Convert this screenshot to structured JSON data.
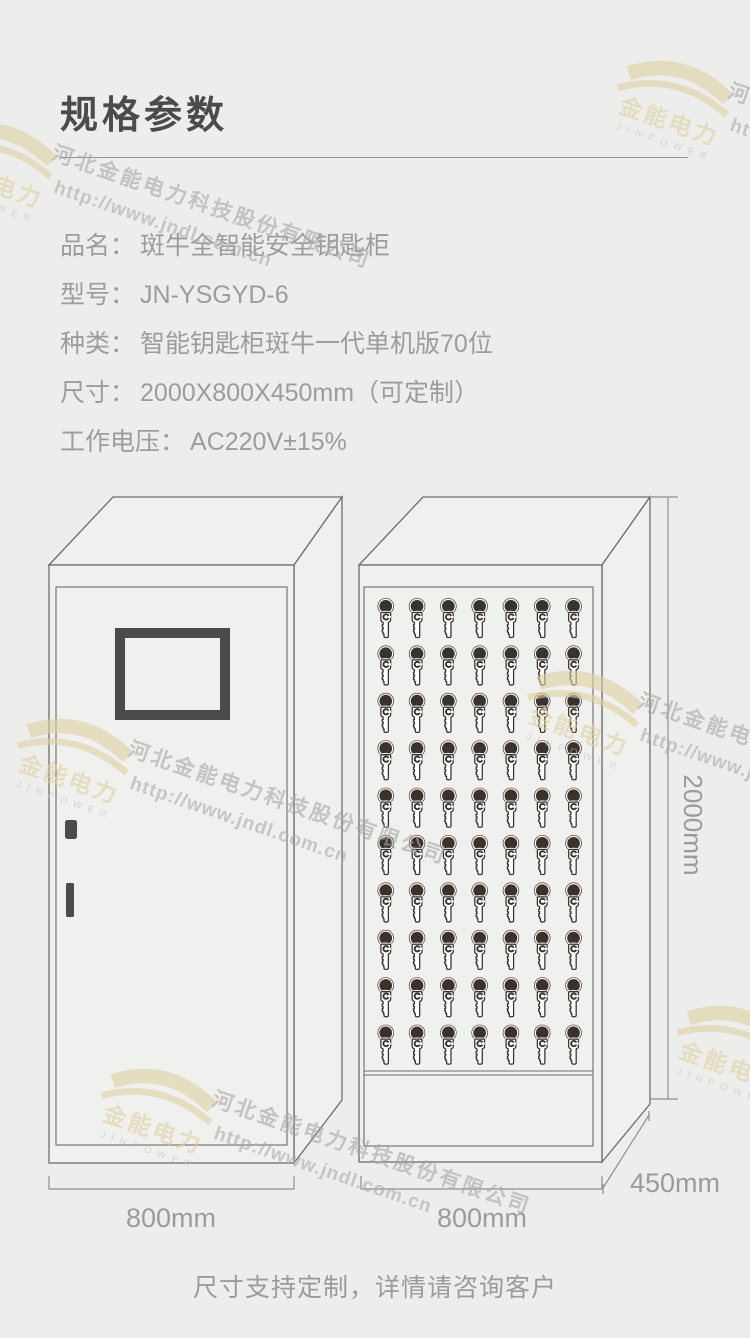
{
  "page": {
    "bg_color": "#edeeec",
    "accent_dark": "#4b4b4b",
    "text_gray": "#9b9b9b"
  },
  "header": {
    "title": "规格参数"
  },
  "specs": [
    {
      "label": "品名：",
      "value": "斑牛全智能安全钥匙柜"
    },
    {
      "label": "型号：",
      "value": "JN-YSGYD-6"
    },
    {
      "label": "种类：",
      "value": "智能钥匙柜斑牛一代单机版70位"
    },
    {
      "label": "尺寸：",
      "value": "2000X800X450mm（可定制）"
    },
    {
      "label": "工作电压：",
      "value": "AC220V±15%"
    }
  ],
  "diagram": {
    "left_cabinet": {
      "width_label": "800mm"
    },
    "right_cabinet": {
      "width_label": "800mm",
      "height_label": "2000mm",
      "depth_label": "450mm",
      "key_rows": 10,
      "key_cols": 7,
      "key_count": 70
    }
  },
  "footer": {
    "note": "尺寸支持定制，详情请咨询客户"
  },
  "watermark": {
    "company": "河北金能电力科技股份有限公司",
    "url": "http://www.jndl.com.cn",
    "logo_text": "金能电力",
    "logo_subtext": "JINPOWER",
    "gold_color": "#ddd1a0",
    "text_color": "#a6a6a6"
  }
}
